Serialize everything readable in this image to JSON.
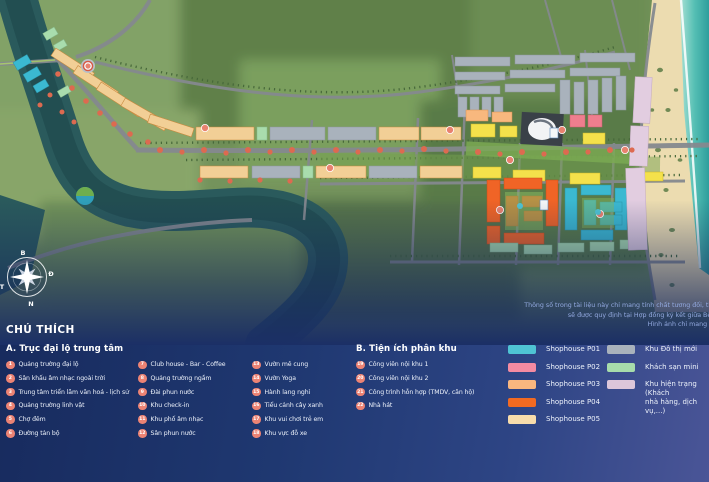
{
  "map": {
    "compass": {
      "north": "B",
      "east": "Đ",
      "south": "N",
      "west": "T"
    }
  },
  "disclaimer": {
    "lines": [
      "Thông số trong tài liệu này chỉ mang tính chất tương đối, thông số chính th",
      "sẽ được quy định tại Hợp đồng ký kết giữa Bên mua và Bên b",
      "Hình ảnh chỉ mang tính chất minh h"
    ]
  },
  "legend": {
    "title": "CHÚ THÍCH",
    "section_a": {
      "title": "A. Trục đại lộ trung tâm",
      "items": [
        {
          "num": "1",
          "label": "Quảng trường đại lộ"
        },
        {
          "num": "2",
          "label": "Sân khấu âm nhạc ngoài trời"
        },
        {
          "num": "3",
          "label": "Trung tâm triển lãm văn hoá - lịch sử"
        },
        {
          "num": "4",
          "label": "Quảng trường linh vật"
        },
        {
          "num": "5",
          "label": "Chợ đêm"
        },
        {
          "num": "6",
          "label": "Đường tản bộ"
        },
        {
          "num": "7",
          "label": "Club house - Bar - Coffee"
        },
        {
          "num": "8",
          "label": "Quảng trường ngầm"
        },
        {
          "num": "9",
          "label": "Đài phun nước"
        },
        {
          "num": "10",
          "label": "Khu check-in"
        },
        {
          "num": "11",
          "label": "Khu phố âm nhạc"
        },
        {
          "num": "12",
          "label": "Sân phun nước"
        },
        {
          "num": "13",
          "label": "Vườn mê cung"
        },
        {
          "num": "14",
          "label": "Vườn Yoga"
        },
        {
          "num": "15",
          "label": "Hành lang nghỉ"
        },
        {
          "num": "16",
          "label": "Tiểu cảnh cây xanh"
        },
        {
          "num": "17",
          "label": "Khu vui chơi trẻ em"
        },
        {
          "num": "18",
          "label": "Khu vực đỗ xe"
        }
      ]
    },
    "section_b": {
      "title": "B. Tiện ích phân khu",
      "items": [
        {
          "num": "19",
          "label": "Công viên nội khu 1"
        },
        {
          "num": "20",
          "label": "Công viên nội khu 2"
        },
        {
          "num": "21",
          "label": "Công trình hỗn hợp (TMDV, căn hộ)"
        },
        {
          "num": "22",
          "label": "Nhà hát"
        }
      ]
    },
    "swatches_left": [
      {
        "color": "#4fc4d4",
        "label": "Shophouse P01"
      },
      {
        "color": "#f48ba2",
        "label": "Shophouse P02"
      },
      {
        "color": "#f9b77f",
        "label": "Shophouse P03"
      },
      {
        "color": "#f26a22",
        "label": "Shophouse P04"
      },
      {
        "color": "#f7dcab",
        "label": "Shophouse P05"
      }
    ],
    "swatches_right": [
      {
        "color": "#a9b2bc",
        "label": "Khu Đô thị mới"
      },
      {
        "color": "#a7dcab",
        "label": "Khách sạn mini"
      },
      {
        "color": "#dcc6da",
        "label": "Khu hiện trạng (Khách\nnhà hàng, dịch vụ,...)"
      }
    ]
  }
}
